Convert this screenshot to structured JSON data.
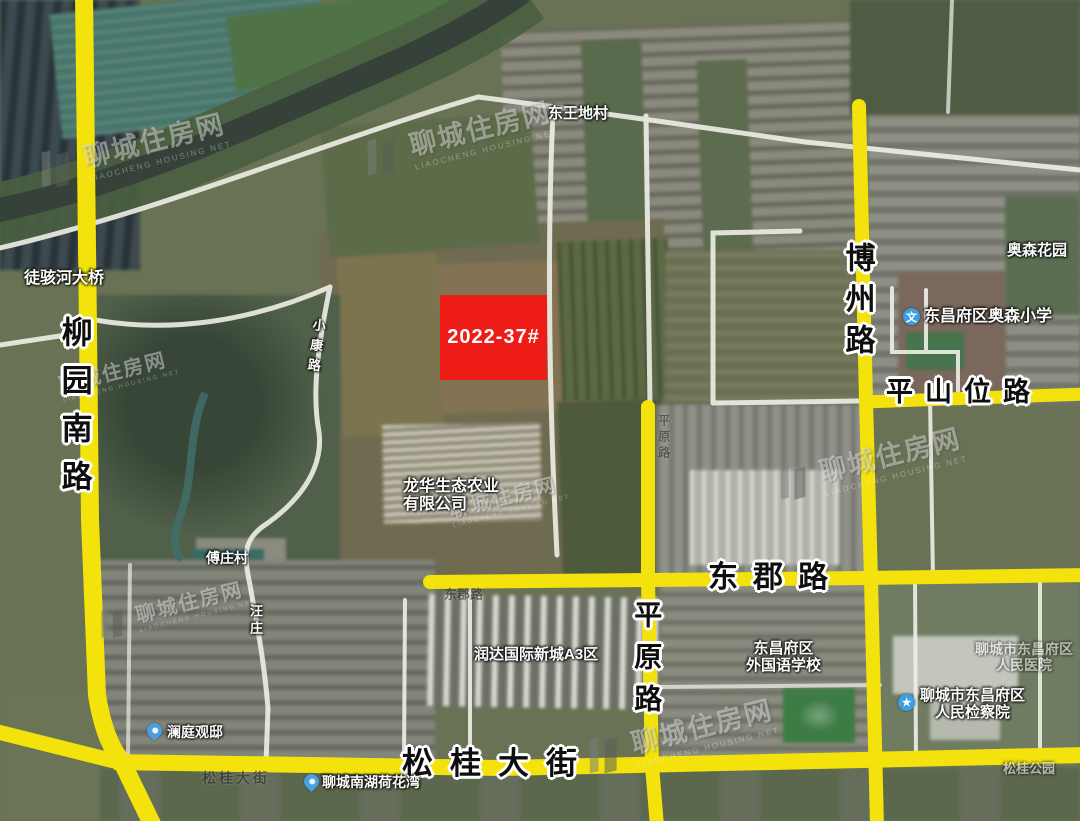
{
  "map": {
    "parcel": {
      "label": "2022-37#"
    },
    "roads": {
      "liuyuan_south": "柳园南路",
      "bozhou": "博州路",
      "pingshanwei": "平山位路",
      "dongjun": "东郡路",
      "pingyuan": "平原路",
      "songgui_avenue": "松桂大街"
    },
    "places": {
      "tuhai_bridge": "徒骇河大桥",
      "dongwangdi_village": "东王地村",
      "xiaokang_road": "小康路",
      "longhua_line1": "龙华生态农业",
      "longhua_line2": "有限公司",
      "fuzhuang_village": "傅庄村",
      "wangzhuang": "汪庄",
      "runda_a3": "润达国际新城A3区",
      "foreign_school_line1": "东昌府区",
      "foreign_school_line2": "外国语学校",
      "aosen_primary": "东昌府区奥森小学",
      "aosen_garden": "奥森花园",
      "procuratorate_line1": "聊城市东昌府区",
      "procuratorate_line2": "人民检察院",
      "hospital_line1": "聊城市东昌府区",
      "hospital_line2": "人民医院",
      "lanting_mansion": "澜庭观邸",
      "nanhu_lotus_bay": "聊城南湖荷花湾",
      "songgui_faint": "松桂大街",
      "songgui_park": "松桂公园",
      "dongjun_faint": "东郡路",
      "pingyuan_faint": "平原路"
    },
    "icons": {
      "school_glyph": "文",
      "gov_glyph": "★"
    },
    "watermark": {
      "brand": "聊城住房网",
      "subtitle": "LIAOCHENG HOUSING NET"
    },
    "colors": {
      "parcel_red": "#ed1c16",
      "road_yellow": "#f3e20c"
    }
  }
}
